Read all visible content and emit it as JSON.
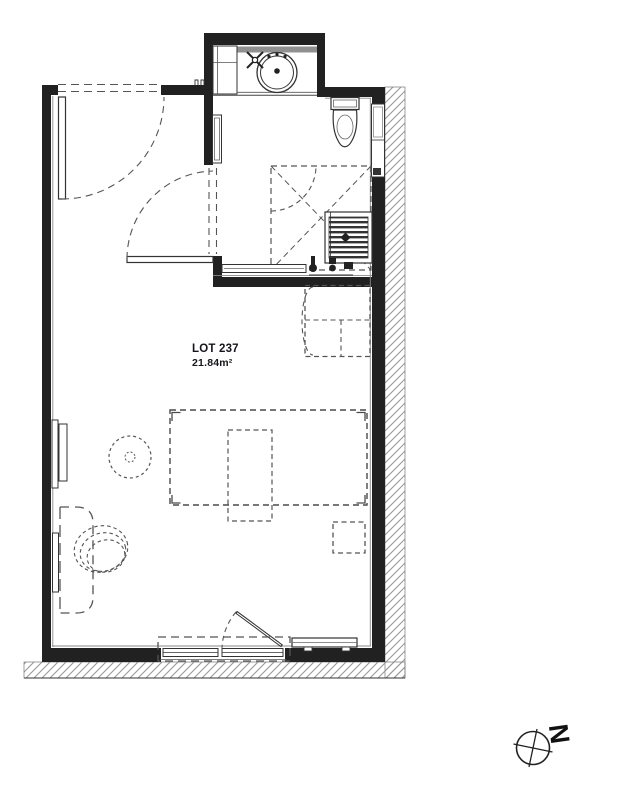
{
  "plan": {
    "lot_label": "LOT 237",
    "area_label": "21.84m²"
  },
  "compass": {
    "north_label": "N"
  },
  "colors": {
    "background": "#ffffff",
    "wall": "#212121",
    "line": "#333333",
    "dashed": "#555555",
    "hatch": "#9a9a9a",
    "counter_backsplash": "#909090",
    "label_text": "#15151f"
  },
  "fixtures": {
    "bathroom": [
      "vanity-washbasin",
      "faucet-cross",
      "shelf-unit",
      "mirror-panel",
      "toilet",
      "wall-niche",
      "shower-area",
      "shower-bench",
      "shower-drain",
      "plumbing-fixtures"
    ],
    "kitchen": [
      "kitchenette-unit"
    ],
    "living": [
      "bed",
      "bed-rug",
      "bedside-table",
      "desk",
      "chair",
      "stool",
      "radiator-left-upper",
      "radiator-left-lower",
      "radiator-bottom"
    ],
    "openings": [
      "entrance-door",
      "bathroom-door",
      "fixed-window",
      "french-window",
      "window-guard"
    ]
  }
}
